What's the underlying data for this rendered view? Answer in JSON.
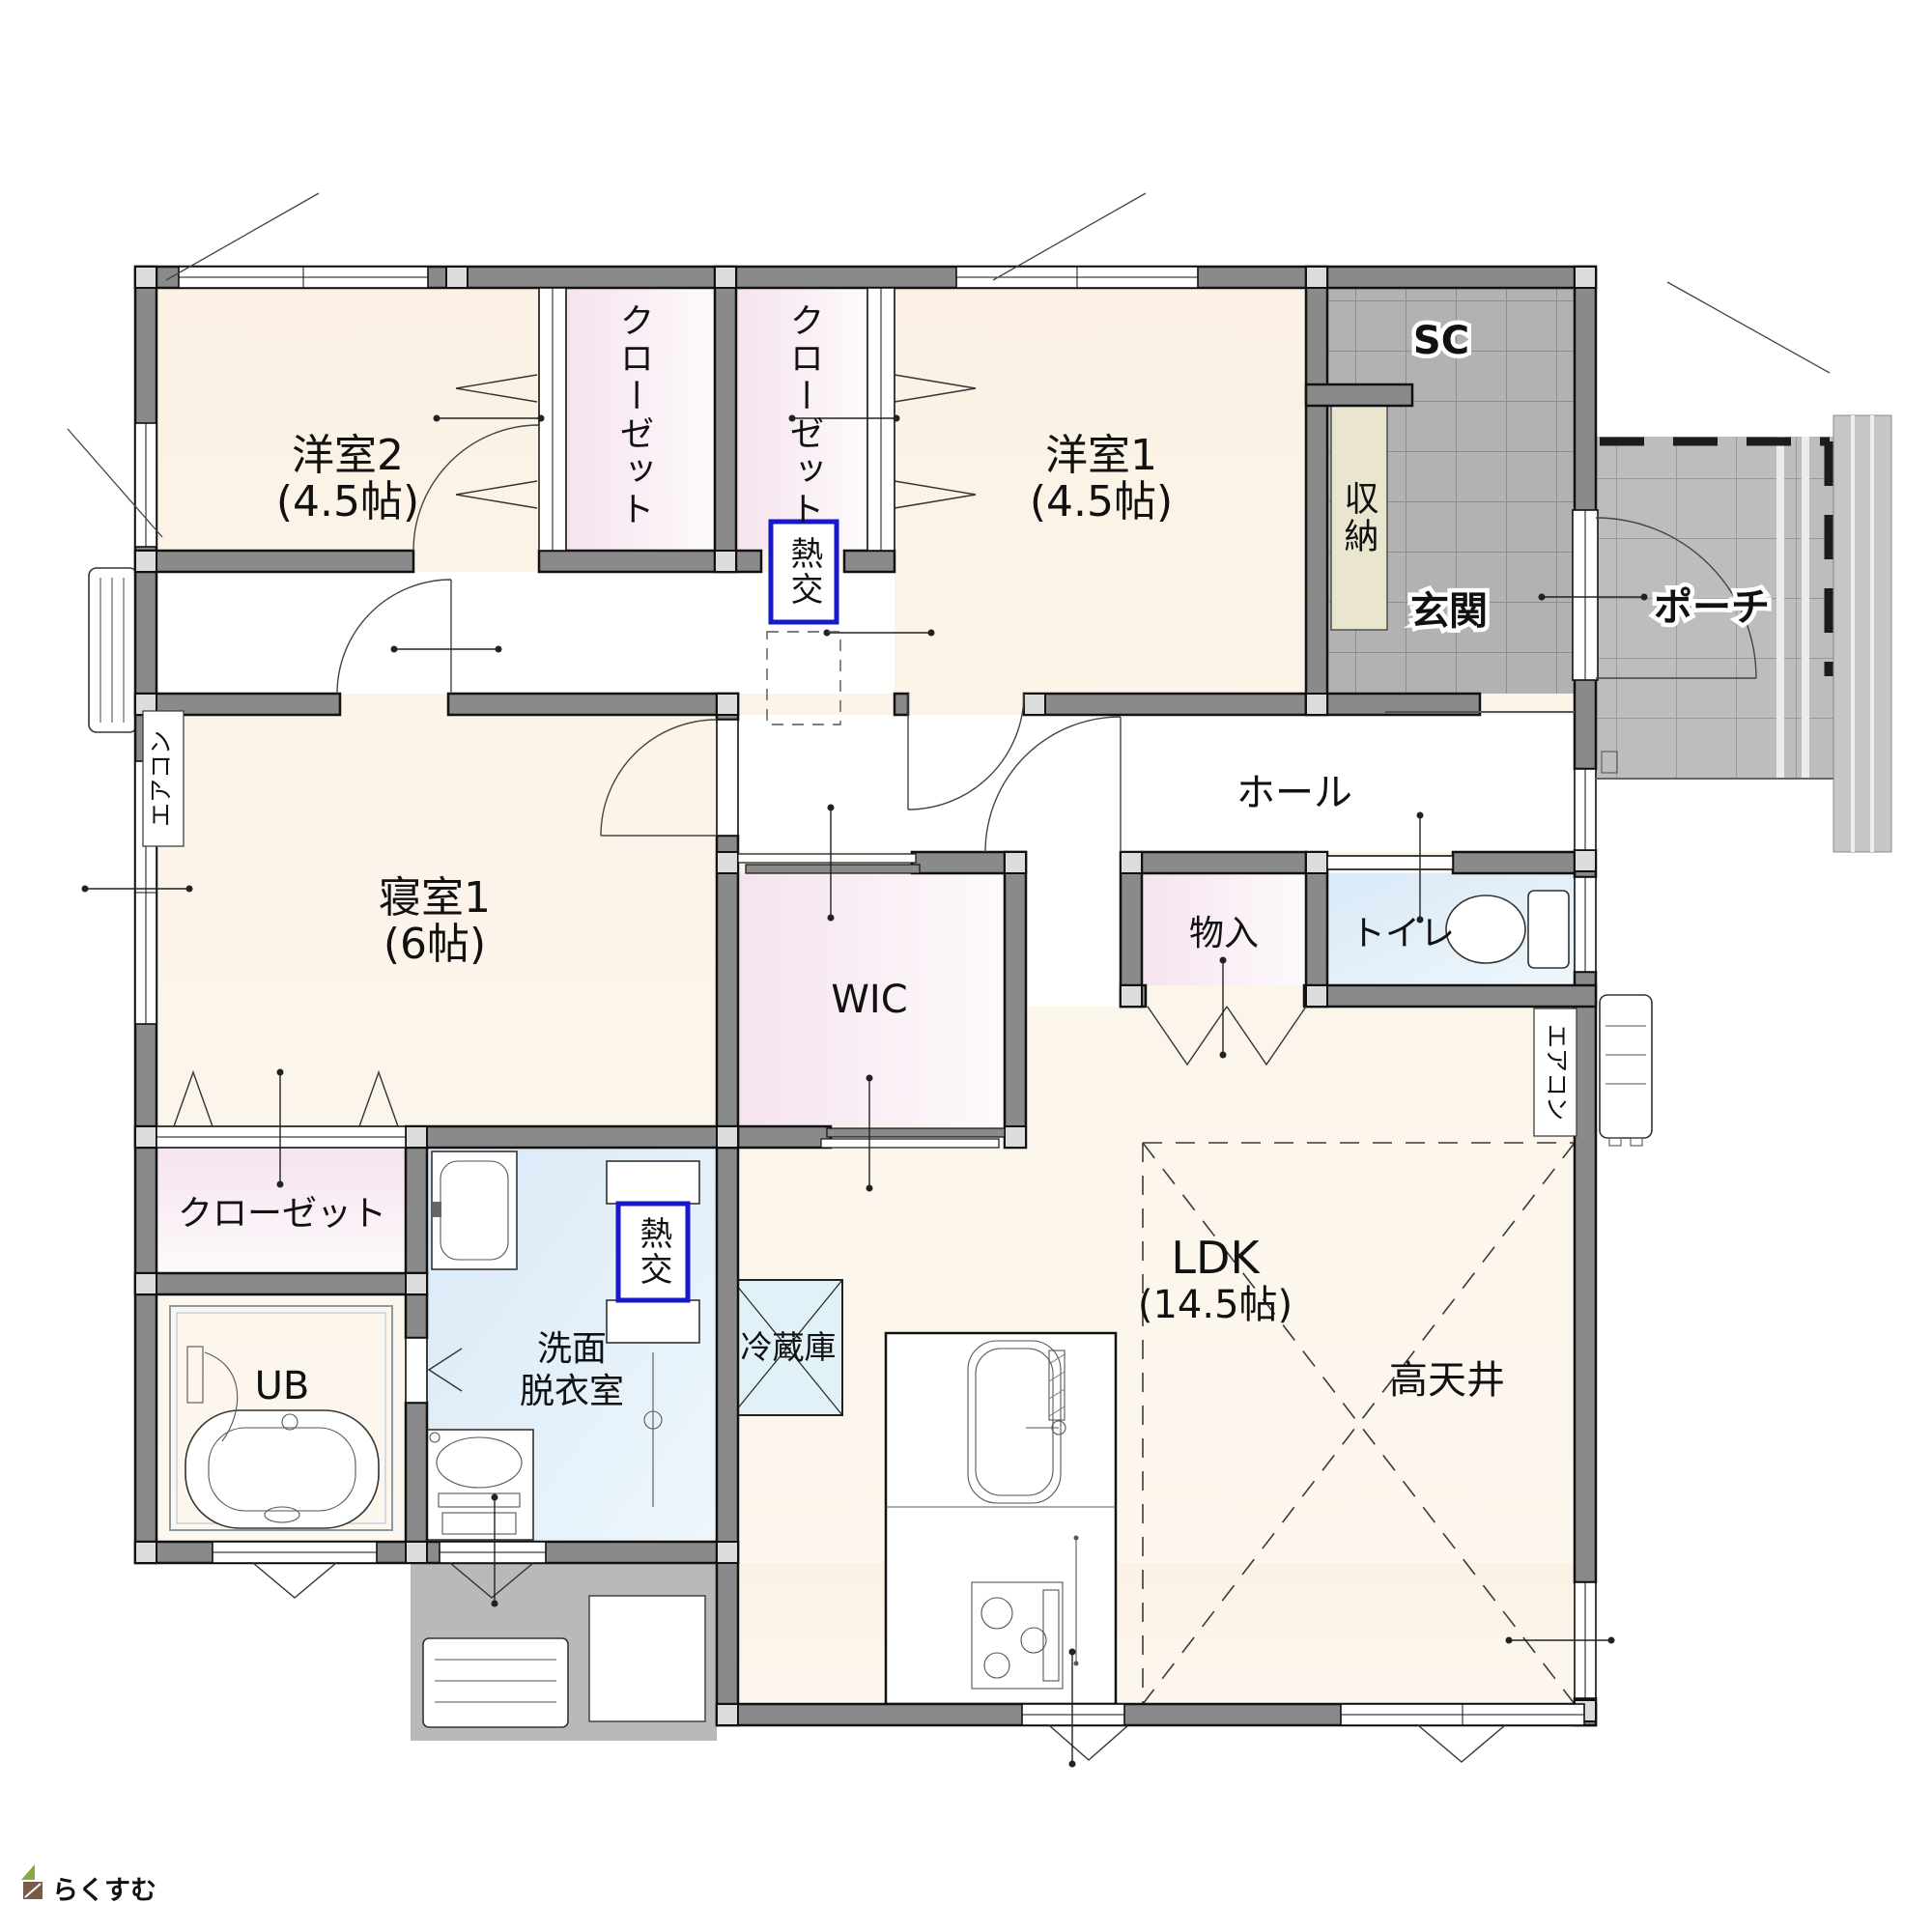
{
  "plan": {
    "rooms": {
      "western2": {
        "name": "洋室2",
        "size": "(4.5帖)"
      },
      "western1": {
        "name": "洋室1",
        "size": "(4.5帖)"
      },
      "bedroom1": {
        "name": "寝室1",
        "size": "(6帖)"
      },
      "ldk": {
        "name": "LDK",
        "size": "(14.5帖)"
      },
      "hall": "ホール",
      "entrance": "玄関",
      "porch": "ポーチ",
      "shoe_closet": "SC",
      "storage": "収納",
      "closet_a": "クローゼット",
      "closet_b": "クローゼット",
      "closet_c": "クローゼット",
      "wic": "WIC",
      "small_storage": "物入",
      "toilet": "トイレ",
      "unit_bath": "UB",
      "washroom": {
        "line1": "洗面",
        "line2": "脱衣室"
      },
      "refrigerator": "冷蔵庫",
      "high_ceiling": "高天井"
    },
    "equipment": {
      "heat_exchanger_1": "熱交",
      "heat_exchanger_2": "熱交",
      "aircon_left": "エアコン",
      "aircon_right": "エアコン"
    },
    "logo": "らくすむ",
    "colors": {
      "wall": "#8a8a8a",
      "room_cream": "#fbf3e8",
      "closet_pink": "#f6e3ef",
      "water_blue": "#d9e9f7",
      "entrance_tile": "#b2b2b2",
      "porch_tile": "#bdbdbd",
      "terrace": "#b9b9b9",
      "storage_fill": "#e9e5cf",
      "fridge_fill": "#e0f1f7",
      "heat_exchanger_border": "#1717cc",
      "logo_brown": "#8a5a3c"
    }
  }
}
